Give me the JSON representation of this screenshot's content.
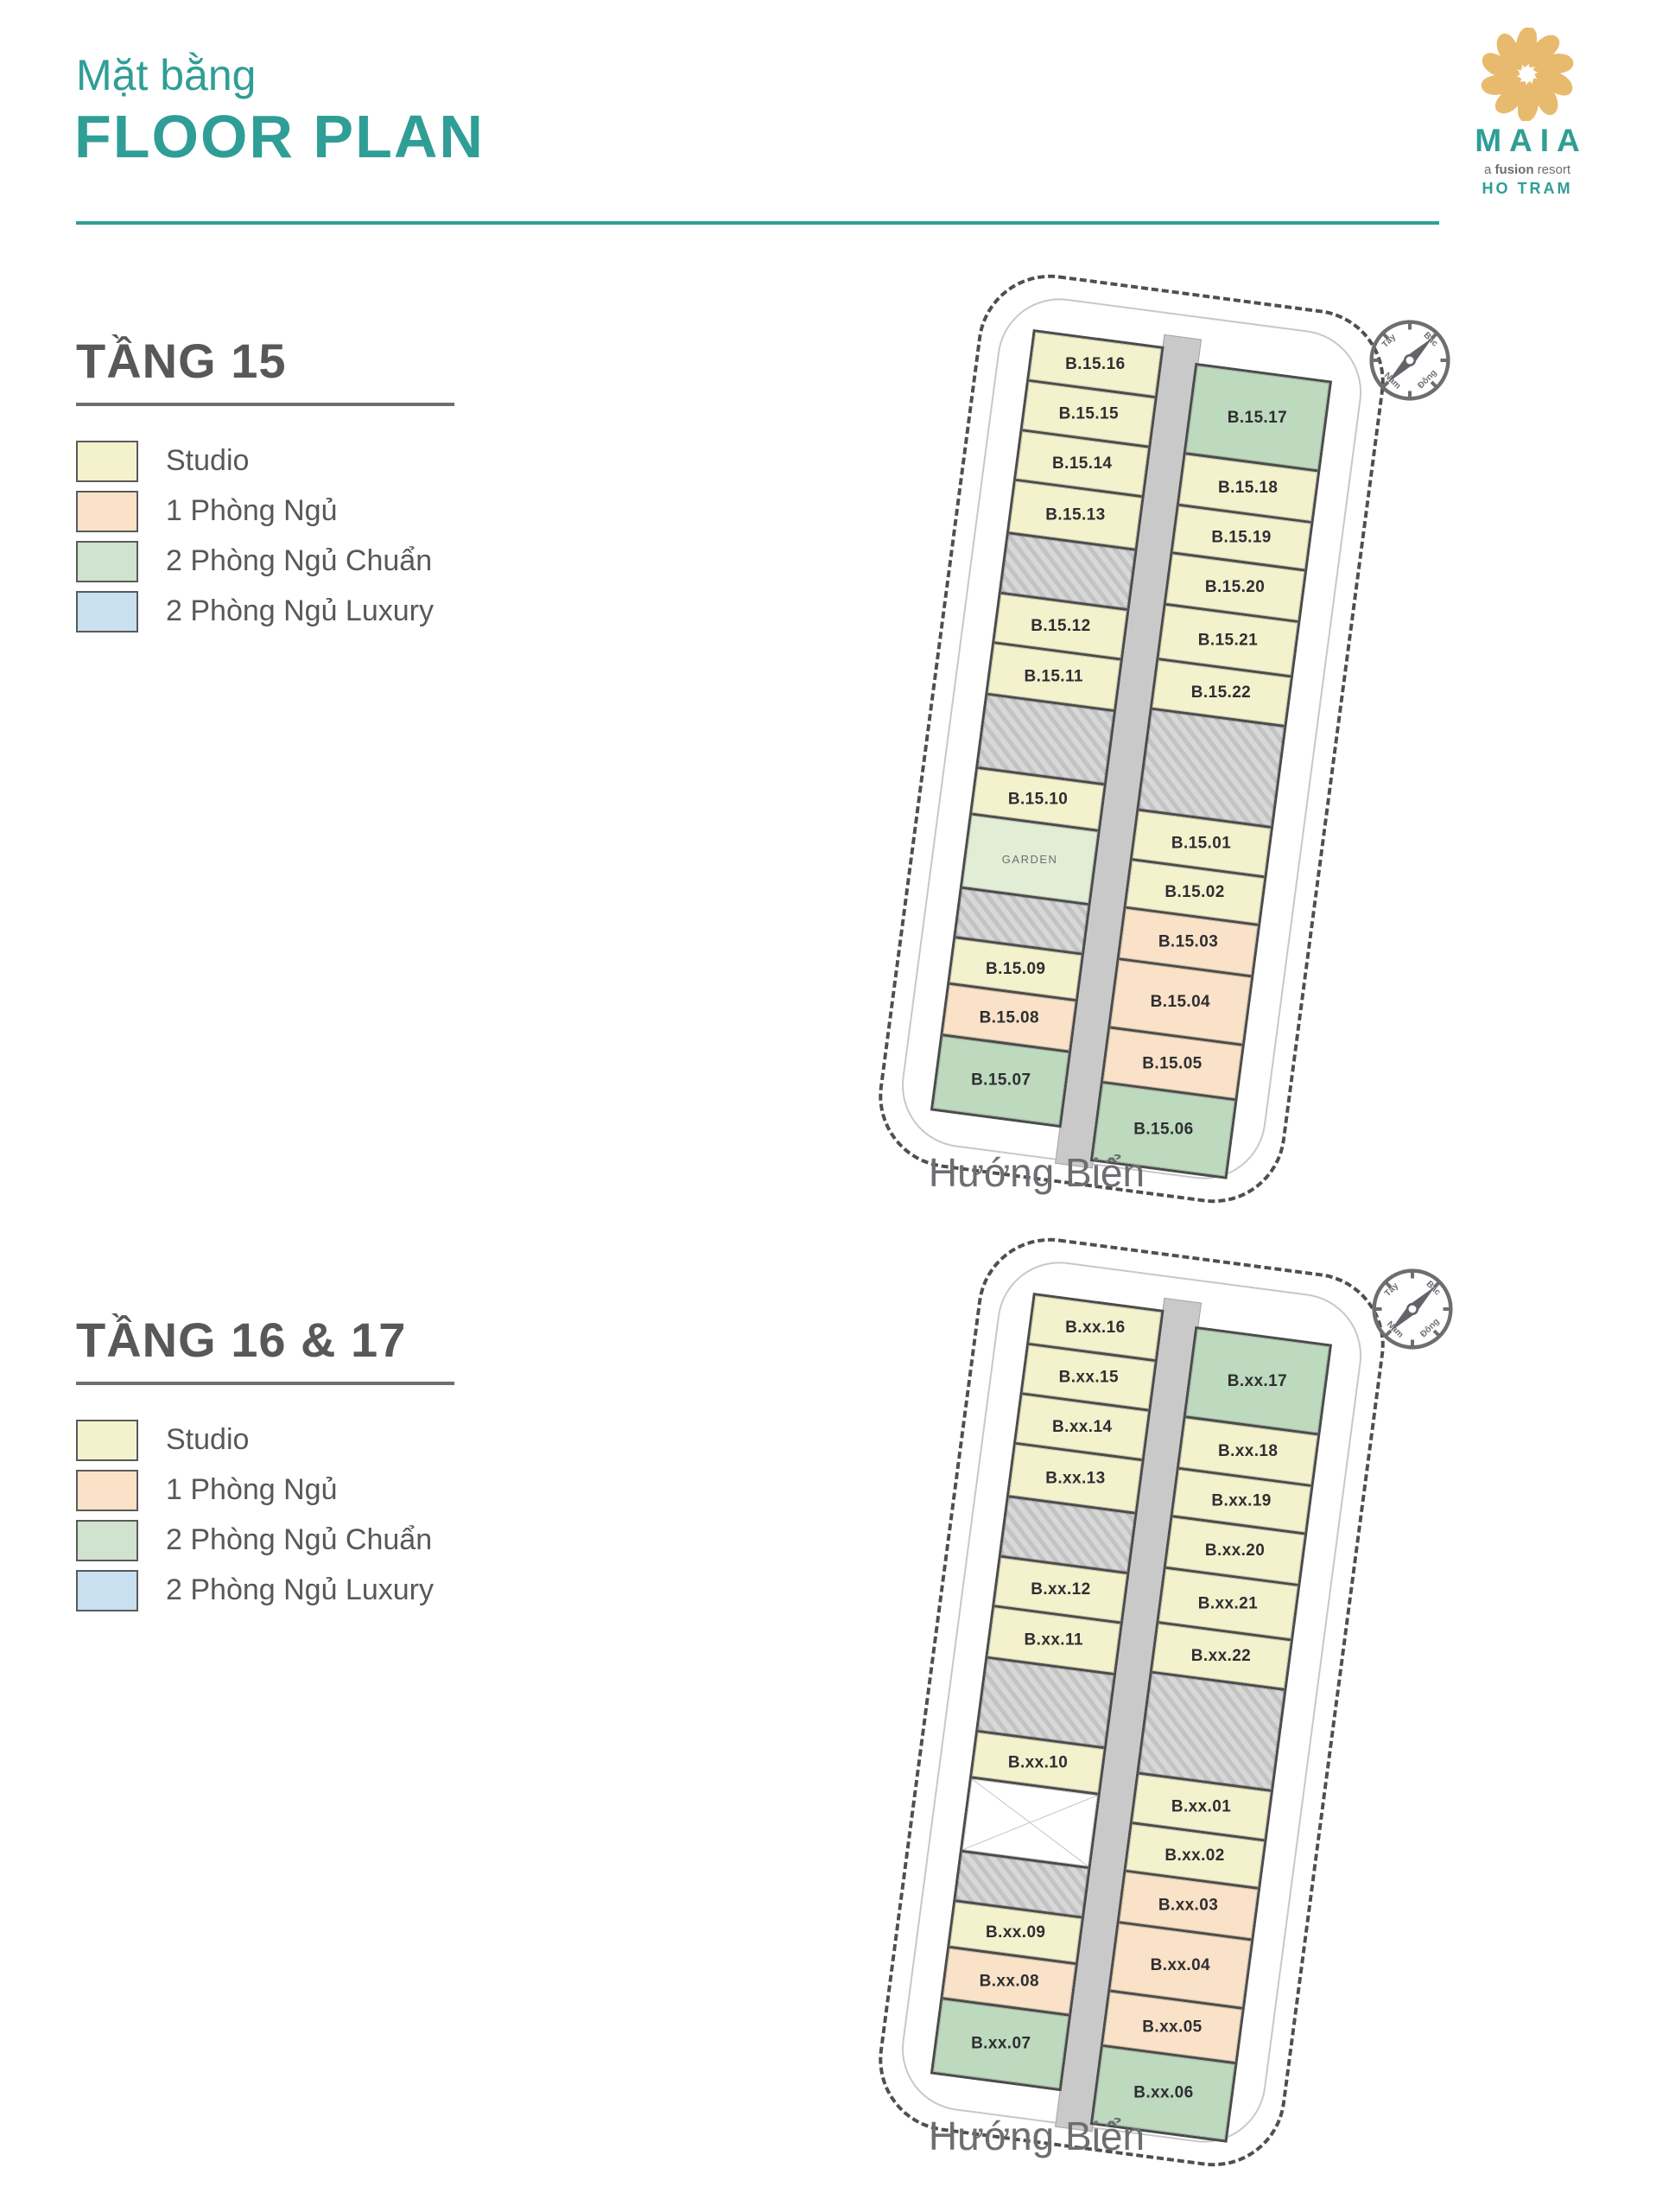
{
  "header": {
    "subtitle": "Mặt bằng",
    "title": "FLOOR PLAN"
  },
  "logo": {
    "name": "MAIA",
    "tagline_a": "a",
    "tagline_b": "fusion",
    "tagline_c": "resort",
    "location": "HO TRAM",
    "flower_color": "#e8ba6d",
    "teal": "#2f9e96"
  },
  "legend_items": [
    {
      "label": "Studio",
      "color": "#f4f1cd"
    },
    {
      "label": "1 Phòng Ngủ",
      "color": "#f9e2c7"
    },
    {
      "label": "2 Phòng Ngủ Chuẩn",
      "color": "#cfe3cf"
    },
    {
      "label": "2 Phòng Ngủ Luxury",
      "color": "#c8e0f0"
    }
  ],
  "compass": {
    "north": "Bắc",
    "east": "Đông",
    "south": "Nam",
    "west": "Tây"
  },
  "floors": [
    {
      "title": "TẦNG 15",
      "sea_label": "Hướng Biển",
      "garden_label": "GARDEN",
      "left_units": [
        {
          "label": "B.15.16",
          "type": "studio",
          "h": 58
        },
        {
          "label": "B.15.15",
          "type": "studio",
          "h": 58
        },
        {
          "label": "B.15.14",
          "type": "studio",
          "h": 58
        },
        {
          "label": "B.15.13",
          "type": "studio",
          "h": 62
        },
        {
          "type": "core",
          "h": 70
        },
        {
          "label": "B.15.12",
          "type": "studio",
          "h": 58
        },
        {
          "label": "B.15.11",
          "type": "studio",
          "h": 60
        },
        {
          "type": "core",
          "h": 86
        },
        {
          "label": "B.15.10",
          "type": "studio",
          "h": 54
        },
        {
          "type": "garden",
          "h": 86
        },
        {
          "type": "core",
          "h": 58
        },
        {
          "label": "B.15.09",
          "type": "studio",
          "h": 54
        },
        {
          "label": "B.15.08",
          "type": "1br",
          "h": 60
        },
        {
          "label": "B.15.07",
          "type": "2br",
          "h": 84
        }
      ],
      "right_units": [
        {
          "label": "B.15.17",
          "type": "2br",
          "h": 104
        },
        {
          "label": "B.15.18",
          "type": "studio",
          "h": 60
        },
        {
          "label": "B.15.19",
          "type": "studio",
          "h": 56
        },
        {
          "label": "B.15.20",
          "type": "studio",
          "h": 60
        },
        {
          "label": "B.15.21",
          "type": "studio",
          "h": 64
        },
        {
          "label": "B.15.22",
          "type": "studio",
          "h": 58
        },
        {
          "type": "core",
          "h": 118
        },
        {
          "label": "B.15.01",
          "type": "studio",
          "h": 58
        },
        {
          "label": "B.15.02",
          "type": "studio",
          "h": 56
        },
        {
          "label": "B.15.03",
          "type": "1br",
          "h": 60
        },
        {
          "label": "B.15.04",
          "type": "1br",
          "h": 80
        },
        {
          "label": "B.15.05",
          "type": "1br",
          "h": 64
        },
        {
          "label": "B.15.06",
          "type": "2br",
          "h": 88
        }
      ]
    },
    {
      "title": "TẦNG 16 & 17",
      "sea_label": "Hướng Biển",
      "garden_label": "",
      "left_units": [
        {
          "label": "B.xx.16",
          "type": "studio",
          "h": 58
        },
        {
          "label": "B.xx.15",
          "type": "studio",
          "h": 58
        },
        {
          "label": "B.xx.14",
          "type": "studio",
          "h": 58
        },
        {
          "label": "B.xx.13",
          "type": "studio",
          "h": 62
        },
        {
          "type": "core",
          "h": 70
        },
        {
          "label": "B.xx.12",
          "type": "studio",
          "h": 58
        },
        {
          "label": "B.xx.11",
          "type": "studio",
          "h": 60
        },
        {
          "type": "core",
          "h": 86
        },
        {
          "label": "B.xx.10",
          "type": "studio",
          "h": 54
        },
        {
          "type": "void",
          "h": 86
        },
        {
          "type": "core",
          "h": 58
        },
        {
          "label": "B.xx.09",
          "type": "studio",
          "h": 54
        },
        {
          "label": "B.xx.08",
          "type": "1br",
          "h": 60
        },
        {
          "label": "B.xx.07",
          "type": "2br",
          "h": 84
        }
      ],
      "right_units": [
        {
          "label": "B.xx.17",
          "type": "2br",
          "h": 104
        },
        {
          "label": "B.xx.18",
          "type": "studio",
          "h": 60
        },
        {
          "label": "B.xx.19",
          "type": "studio",
          "h": 56
        },
        {
          "label": "B.xx.20",
          "type": "studio",
          "h": 60
        },
        {
          "label": "B.xx.21",
          "type": "studio",
          "h": 64
        },
        {
          "label": "B.xx.22",
          "type": "studio",
          "h": 58
        },
        {
          "type": "core",
          "h": 118
        },
        {
          "label": "B.xx.01",
          "type": "studio",
          "h": 58
        },
        {
          "label": "B.xx.02",
          "type": "studio",
          "h": 56
        },
        {
          "label": "B.xx.03",
          "type": "1br",
          "h": 60
        },
        {
          "label": "B.xx.04",
          "type": "1br",
          "h": 80
        },
        {
          "label": "B.xx.05",
          "type": "1br",
          "h": 64
        },
        {
          "label": "B.xx.06",
          "type": "2br",
          "h": 88
        }
      ]
    }
  ]
}
